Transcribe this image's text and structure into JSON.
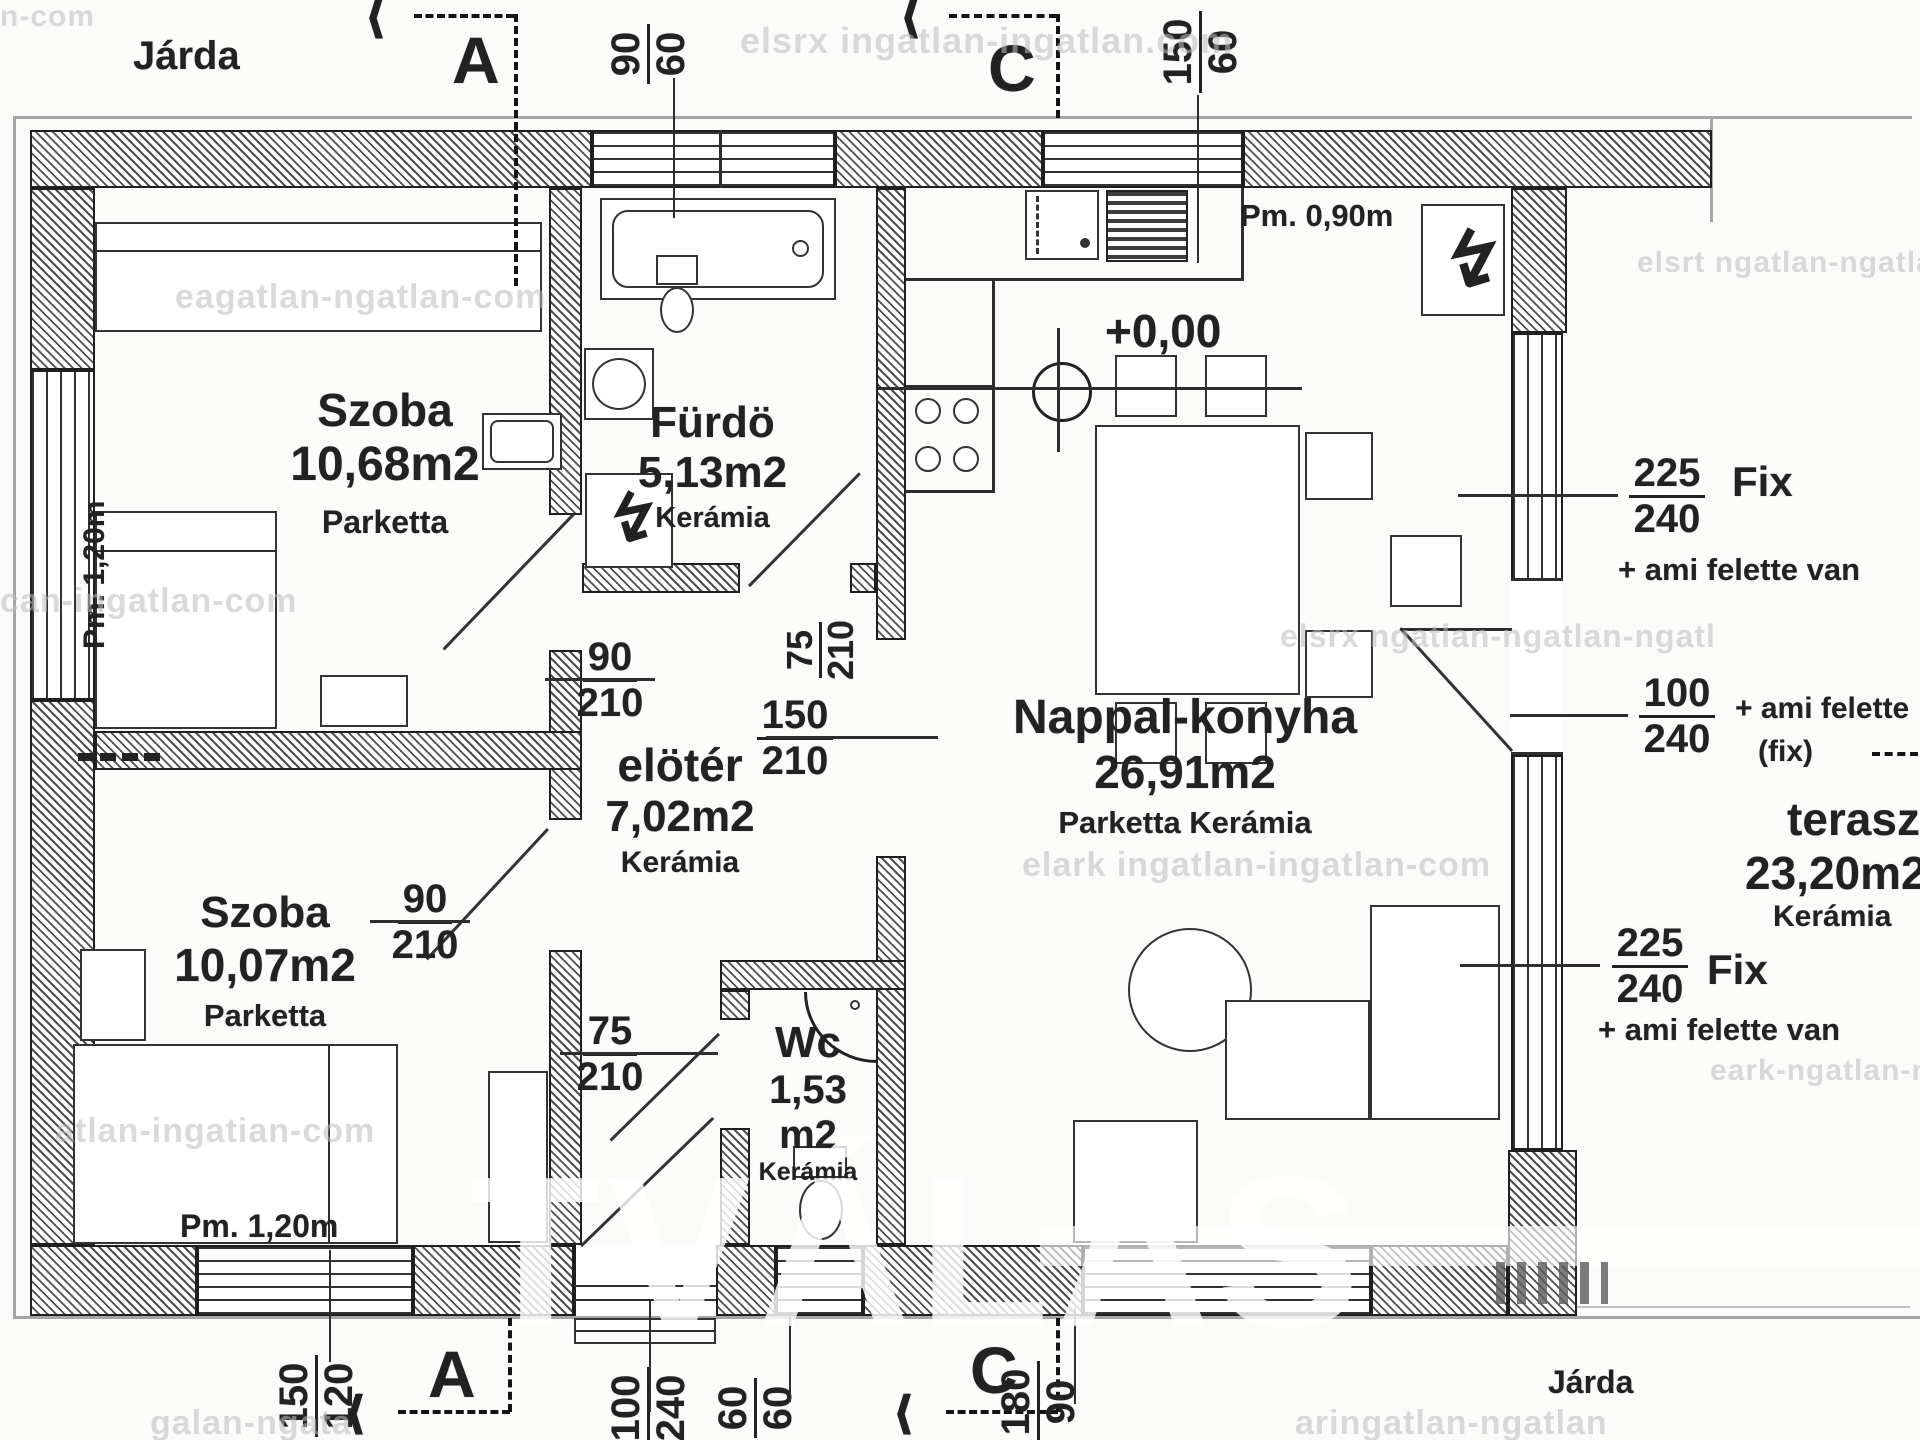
{
  "labels": {
    "sidewalk_top": "Járda",
    "sidewalk_bottom": "Járda"
  },
  "section_markers": {
    "a": "A",
    "c": "C"
  },
  "icons": {
    "section_arrow": "⟨⟨⟨",
    "electric": "↯"
  },
  "rooms": [
    {
      "name": "Szoba",
      "area": "10,68m2",
      "floor": "Parketta"
    },
    {
      "name": "Fürdö",
      "area": "5,13m2",
      "floor": "Kerámia"
    },
    {
      "name": "Nappal-konyha",
      "area": "26,91m2",
      "floor": "Parketta Kerámia"
    },
    {
      "name": "elötér",
      "area": "7,02m2",
      "floor": "Kerámia"
    },
    {
      "name": "Szoba",
      "area": "10,07m2",
      "floor": "Parketta"
    },
    {
      "name": "Wc",
      "area": "1,53",
      "area2": "m2",
      "floor": "Kerámia"
    },
    {
      "name": "terasz",
      "area": "23,20m2",
      "floor": "Kerámia"
    }
  ],
  "levels": {
    "floor_level": "+0,00",
    "parapet_left": "Pm. 1,20m",
    "parapet_bottom": "Pm. 1,20m",
    "parapet_kitchen": "Pm. 0,90m"
  },
  "openings": {
    "top_window_bath": {
      "w": "90",
      "h": "60"
    },
    "top_window_kitchen": {
      "w": "150",
      "h": "60"
    },
    "bottom_window_bedroom2": {
      "w": "150",
      "h": "120"
    },
    "bottom_door_entrance": {
      "w": "100",
      "h": "240"
    },
    "bottom_window_wc": {
      "w": "60",
      "h": "60"
    },
    "bottom_window_living": {
      "w": "180",
      "h": "90"
    },
    "door_bedroom1": {
      "w": "90",
      "h": "210"
    },
    "door_bedroom2": {
      "w": "90",
      "h": "210"
    },
    "door_bath": {
      "w": "75",
      "h": "210"
    },
    "door_wc": {
      "w": "75",
      "h": "210"
    },
    "opening_hall_living": {
      "w": "150",
      "h": "210"
    },
    "terrace_fix_upper": {
      "w": "225",
      "h": "240",
      "note": "Fix",
      "note2": "+ ami felette van"
    },
    "terrace_door": {
      "w": "100",
      "h": "240",
      "note": "+ ami felette",
      "note2": "(fix)"
    },
    "terrace_fix_lower": {
      "w": "225",
      "h": "240",
      "note": "Fix",
      "note2": "+ ami felette van"
    }
  },
  "watermarks": [
    "n-com",
    "elsrx ingatlan-ingatlan.com",
    "elsrt ngatlan-ngatlan-ngat",
    "can-ingatlan-com",
    "eagatlan-ngatlan-com",
    "elark ingatlan-ingatlan-com",
    "atlan-ingatian-com",
    "eark-ngatlan-ngatlan",
    "galan-ngata",
    "aringatlan-ngatlan",
    "elsrx ngatlan-ngatlan-ngatl"
  ],
  "logo_watermark": "TVÁLAS"
}
